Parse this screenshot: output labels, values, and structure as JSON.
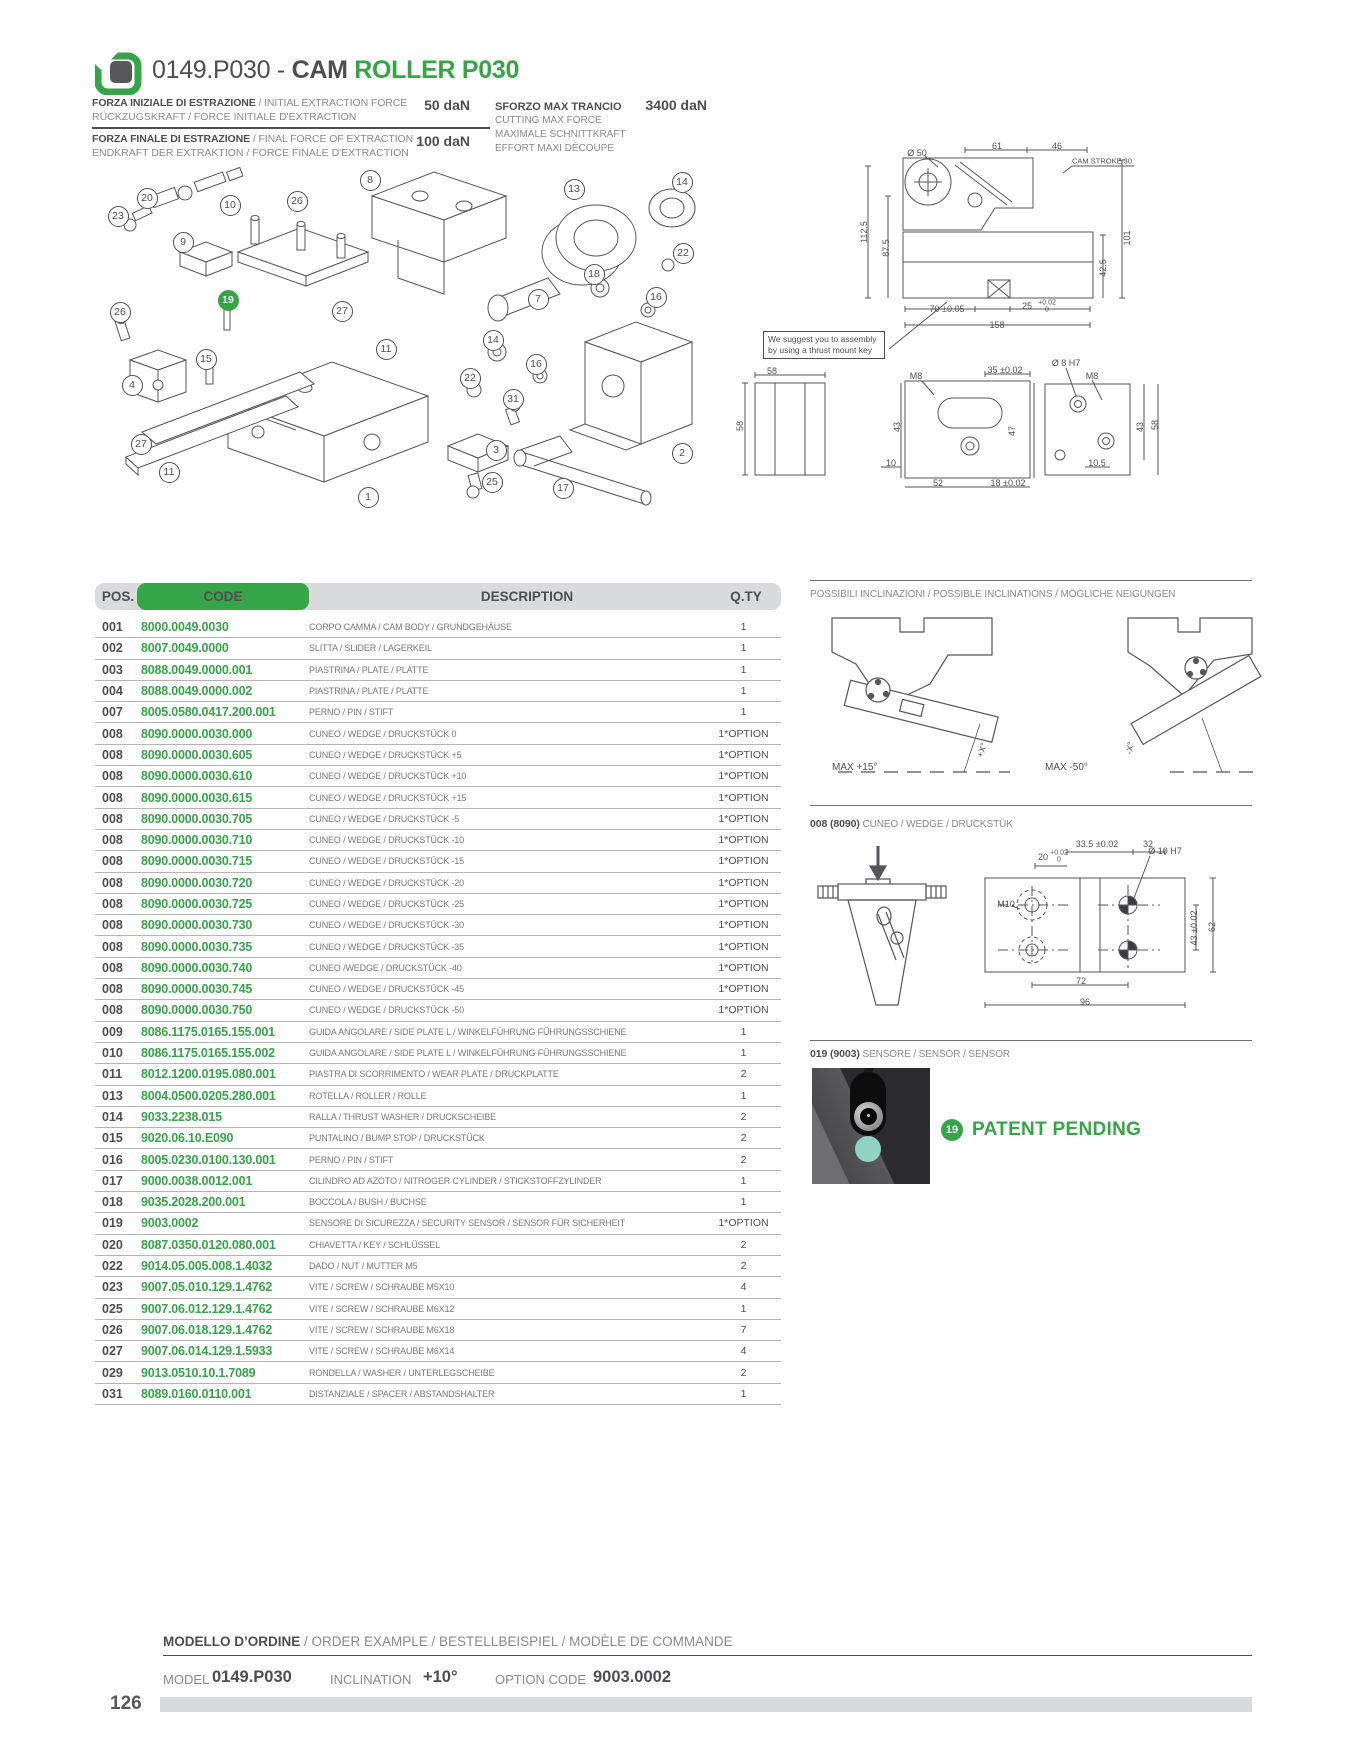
{
  "colors": {
    "accent_green": "#36a548",
    "dark_text": "#4e4e50",
    "muted_text": "#8a8a8c",
    "table_header_bg": "#d9dadb",
    "row_line": "#b4b4b6",
    "sensor_led_teal": "#8fd4c2"
  },
  "header": {
    "title_prefix": "0149.P030 - ",
    "title_cam": "CAM",
    "title_green": " ROLLER P030",
    "specs": [
      {
        "line1_bold": "FORZA INIZIALE DI ESTRAZIONE",
        "line1_rest": " / INITIAL EXTRACTION FORCE",
        "line2": "RÜCKZUGSKRAFT / FORCE INITIALE D'EXTRACTION",
        "value": "50 daN"
      },
      {
        "line1_bold": "FORZA FINALE DI ESTRAZIONE",
        "line1_rest": " / FINAL FORCE OF EXTRACTION",
        "line2": "ENDKRAFT DER EXTRAKTION / FORCE FINALE D'EXTRACTION",
        "value": "100 daN"
      }
    ],
    "max_shear": {
      "label": "SFORZO MAX TRANCIO",
      "value": "3400 daN",
      "sub1": "CUTTING MAX FORCE",
      "sub2": "MAXIMALE SCHNITTKRAFT",
      "sub3": "EFFORT MAXI DÉCOUPE"
    }
  },
  "drawings": {
    "note": "We suggest you to assembly by using a thrust mount key",
    "cam_stroke_label": "CAM STROKE 30"
  },
  "table": {
    "headers": {
      "pos": "POS.",
      "code": "CODE",
      "description": "DESCRIPTION",
      "qty": "Q.TY"
    },
    "rows": [
      {
        "pos": "001",
        "code": "8000.0049.0030",
        "desc": "CORPO CAMMA / CAM BODY / GRUNDGEHÄUSE",
        "qty": "1"
      },
      {
        "pos": "002",
        "code": "8007.0049.0000",
        "desc": "SLITTA / SLIDER / LAGERKEIL",
        "qty": "1"
      },
      {
        "pos": "003",
        "code": "8088.0049.0000.001",
        "desc": "PIASTRINA / PLATE / PLATTE",
        "qty": "1"
      },
      {
        "pos": "004",
        "code": "8088.0049.0000.002",
        "desc": "PIASTRINA / PLATE / PLATTE",
        "qty": "1"
      },
      {
        "pos": "007",
        "code": "8005.0580.0417.200.001",
        "desc": "PERNO / PIN / STIFT",
        "qty": "1"
      },
      {
        "pos": "008",
        "code": "8090.0000.0030.000",
        "desc": "CUNEO / WEDGE / DRUCKSTÜCK 0",
        "qty": "1*OPTION"
      },
      {
        "pos": "008",
        "code": "8090.0000.0030.605",
        "desc": "CUNEO / WEDGE / DRUCKSTÜCK +5",
        "qty": "1*OPTION"
      },
      {
        "pos": "008",
        "code": "8090.0000.0030.610",
        "desc": "CUNEO / WEDGE / DRUCKSTÜCK +10",
        "qty": "1*OPTION"
      },
      {
        "pos": "008",
        "code": "8090.0000.0030.615",
        "desc": "CUNEO / WEDGE / DRUCKSTÜCK +15",
        "qty": "1*OPTION"
      },
      {
        "pos": "008",
        "code": "8090.0000.0030.705",
        "desc": "CUNEO / WEDGE / DRUCKSTÜCK -5",
        "qty": "1*OPTION"
      },
      {
        "pos": "008",
        "code": "8090.0000.0030.710",
        "desc": "CUNEO / WEDGE / DRUCKSTÜCK -10",
        "qty": "1*OPTION"
      },
      {
        "pos": "008",
        "code": "8090.0000.0030.715",
        "desc": "CUNEO / WEDGE / DRUCKSTÜCK -15",
        "qty": "1*OPTION"
      },
      {
        "pos": "008",
        "code": "8090.0000.0030.720",
        "desc": "CUNEO / WEDGE / DRUCKSTÜCK -20",
        "qty": "1*OPTION"
      },
      {
        "pos": "008",
        "code": "8090.0000.0030.725",
        "desc": "CUNEO / WEDGE / DRUCKSTÜCK -25",
        "qty": "1*OPTION"
      },
      {
        "pos": "008",
        "code": "8090.0000.0030.730",
        "desc": "CUNEO / WEDGE / DRUCKSTÜCK -30",
        "qty": "1*OPTION"
      },
      {
        "pos": "008",
        "code": "8090.0000.0030.735",
        "desc": "CUNEO / WEDGE / DRUCKSTÜCK -35",
        "qty": "1*OPTION"
      },
      {
        "pos": "008",
        "code": "8090.0000.0030.740",
        "desc": "CUNEO /WEDGE / DRUCKSTÜCK -40",
        "qty": "1*OPTION"
      },
      {
        "pos": "008",
        "code": "8090.0000.0030.745",
        "desc": "CUNEO / WEDGE / DRUCKSTÜCK -45",
        "qty": "1*OPTION"
      },
      {
        "pos": "008",
        "code": "8090.0000.0030.750",
        "desc": "CUNEO / WEDGE / DRUCKSTÜCK -50",
        "qty": "1*OPTION"
      },
      {
        "pos": "009",
        "code": "8086.1175.0165.155.001",
        "desc": "GUIDA ANGOLARE / SIDE PLATE L / WINKELFÜHRUNG FÜHRUNGSSCHIENE",
        "qty": "1"
      },
      {
        "pos": "010",
        "code": "8086.1175.0165.155.002",
        "desc": "GUIDA ANGOLARE / SIDE PLATE L / WINKELFÜHRUNG FÜHRUNGSSCHIENE",
        "qty": "1"
      },
      {
        "pos": "011",
        "code": "8012.1200.0195.080.001",
        "desc": "PIASTRA DI SCORRIMENTO / WEAR PLATE / DRUCKPLATTE",
        "qty": "2"
      },
      {
        "pos": "013",
        "code": "8004.0500.0205.280.001",
        "desc": "ROTELLA / ROLLER / ROLLE",
        "qty": "1"
      },
      {
        "pos": "014",
        "code": "9033.2238.015",
        "desc": "RALLA / THRUST WASHER / DRUCKSCHEIBE",
        "qty": "2"
      },
      {
        "pos": "015",
        "code": "9020.06.10.E090",
        "desc": "PUNTALINO / BUMP STOP / DRUCKSTÜCK",
        "qty": "2"
      },
      {
        "pos": "016",
        "code": "8005.0230.0100.130.001",
        "desc": "PERNO / PIN / STIFT",
        "qty": "2"
      },
      {
        "pos": "017",
        "code": "9000.0038.0012.001",
        "desc": "CILINDRO AD AZOTO / NITROGER CYLINDER / STICKSTOFFZYLINDER",
        "qty": "1"
      },
      {
        "pos": "018",
        "code": "9035.2028.200.001",
        "desc": "BOCCOLA / BUSH / BUCHSE",
        "qty": "1"
      },
      {
        "pos": "019",
        "code": "9003.0002",
        "desc": "SENSORE DI SICUREZZA / SECURITY SENSOR / SENSOR FÜR SICHERHEIT",
        "qty": "1*OPTION"
      },
      {
        "pos": "020",
        "code": "8087.0350.0120.080.001",
        "desc": "CHIAVETTA / KEY / SCHLÜSSEL",
        "qty": "2"
      },
      {
        "pos": "022",
        "code": "9014.05.005.008.1.4032",
        "desc": "DADO / NUT / MUTTER M5",
        "qty": "2"
      },
      {
        "pos": "023",
        "code": "9007.05.010.129.1.4762",
        "desc": "VITE / SCREW / SCHRAUBE M5X10",
        "qty": "4"
      },
      {
        "pos": "025",
        "code": "9007.06.012.129.1.4762",
        "desc": "VITE / SCREW / SCHRAUBE M6X12",
        "qty": "1"
      },
      {
        "pos": "026",
        "code": "9007.06.018.129.1.4762",
        "desc": "VITE / SCREW / SCHRAUBE M6X18",
        "qty": "7"
      },
      {
        "pos": "027",
        "code": "9007.06.014.129.1.5933",
        "desc": "VITE / SCREW / SCHRAUBE M6X14",
        "qty": "4"
      },
      {
        "pos": "029",
        "code": "9013.0510.10.1.7089",
        "desc": "RONDELLA / WASHER / UNTERLEGSCHEIBE",
        "qty": "2"
      },
      {
        "pos": "031",
        "code": "8089.0160.0110.001",
        "desc": "DISTANZIALE / SPACER / ABSTANDSHALTER",
        "qty": "1"
      }
    ]
  },
  "exploded": {
    "callouts": [
      {
        "n": "23",
        "x": 117,
        "y": 215
      },
      {
        "n": "20",
        "x": 146,
        "y": 197
      },
      {
        "n": "10",
        "x": 229,
        "y": 204
      },
      {
        "n": "26",
        "x": 296,
        "y": 200
      },
      {
        "n": "8",
        "x": 369,
        "y": 179
      },
      {
        "n": "13",
        "x": 573,
        "y": 188
      },
      {
        "n": "14",
        "x": 681,
        "y": 181
      },
      {
        "n": "9",
        "x": 182,
        "y": 241
      },
      {
        "n": "22",
        "x": 682,
        "y": 252
      },
      {
        "n": "18",
        "x": 593,
        "y": 273
      },
      {
        "n": "16",
        "x": 655,
        "y": 296
      },
      {
        "n": "7",
        "x": 537,
        "y": 298
      },
      {
        "n": "19",
        "x": 227,
        "y": 299,
        "g": true
      },
      {
        "n": "27",
        "x": 341,
        "y": 310
      },
      {
        "n": "26",
        "x": 119,
        "y": 311
      },
      {
        "n": "11",
        "x": 385,
        "y": 348
      },
      {
        "n": "14",
        "x": 492,
        "y": 339
      },
      {
        "n": "22",
        "x": 469,
        "y": 377
      },
      {
        "n": "16",
        "x": 535,
        "y": 363
      },
      {
        "n": "31",
        "x": 512,
        "y": 398
      },
      {
        "n": "4",
        "x": 131,
        "y": 384
      },
      {
        "n": "15",
        "x": 205,
        "y": 358
      },
      {
        "n": "3",
        "x": 495,
        "y": 449
      },
      {
        "n": "2",
        "x": 681,
        "y": 452
      },
      {
        "n": "27",
        "x": 140,
        "y": 443
      },
      {
        "n": "11",
        "x": 168,
        "y": 471
      },
      {
        "n": "25",
        "x": 491,
        "y": 481
      },
      {
        "n": "1",
        "x": 367,
        "y": 496
      },
      {
        "n": "17",
        "x": 562,
        "y": 487
      }
    ]
  },
  "annotations": [
    {
      "t": "Ø 50",
      "x": 917,
      "y": 153
    },
    {
      "t": "61",
      "x": 997,
      "y": 146
    },
    {
      "t": "46",
      "x": 1057,
      "y": 146
    },
    {
      "t": "CAM STROKE 30",
      "x": 1102,
      "y": 161,
      "s": 7.5
    },
    {
      "t": "112.5",
      "x": 864,
      "y": 232,
      "r": -90
    },
    {
      "t": "87.5",
      "x": 886,
      "y": 248,
      "r": -90
    },
    {
      "t": "101",
      "x": 1127,
      "y": 238,
      "r": -90
    },
    {
      "t": "42.5",
      "x": 1103,
      "y": 268,
      "r": -90
    },
    {
      "t": "70 ±0.05",
      "x": 947,
      "y": 309
    },
    {
      "t": "25",
      "x": 1027,
      "y": 306
    },
    {
      "t": "+0.02",
      "x": 1047,
      "y": 303,
      "s": 7
    },
    {
      "t": "0",
      "x": 1047,
      "y": 310,
      "s": 7
    },
    {
      "t": "158",
      "x": 997,
      "y": 325
    },
    {
      "t": "58",
      "x": 772,
      "y": 371
    },
    {
      "t": "M8",
      "x": 916,
      "y": 376
    },
    {
      "t": "35 ±0.02",
      "x": 1005,
      "y": 370
    },
    {
      "t": "Ø 8 H7",
      "x": 1066,
      "y": 363
    },
    {
      "t": "M8",
      "x": 1092,
      "y": 376
    },
    {
      "t": "58",
      "x": 740,
      "y": 426,
      "r": -90
    },
    {
      "t": "43",
      "x": 897,
      "y": 427,
      "r": -90
    },
    {
      "t": "47",
      "x": 1012,
      "y": 431,
      "r": -90
    },
    {
      "t": "43",
      "x": 1140,
      "y": 427,
      "r": -90
    },
    {
      "t": "58",
      "x": 1155,
      "y": 425,
      "r": -90
    },
    {
      "t": "10",
      "x": 891,
      "y": 463
    },
    {
      "t": "52",
      "x": 938,
      "y": 483
    },
    {
      "t": "18 ±0.02",
      "x": 1008,
      "y": 483
    },
    {
      "t": "10.5",
      "x": 1097,
      "y": 463
    },
    {
      "t": "+X°",
      "x": 982,
      "y": 750,
      "r": -72
    },
    {
      "t": "-X°",
      "x": 1130,
      "y": 748,
      "r": -80
    },
    {
      "t": "33.5 ±0.02",
      "x": 1097,
      "y": 844
    },
    {
      "t": "32",
      "x": 1148,
      "y": 844
    },
    {
      "t": "20",
      "x": 1043,
      "y": 857
    },
    {
      "t": "+0.02",
      "x": 1059,
      "y": 853,
      "s": 7
    },
    {
      "t": "0",
      "x": 1059,
      "y": 860,
      "s": 7
    },
    {
      "t": "Ø 10 H7",
      "x": 1165,
      "y": 851
    },
    {
      "t": "M10",
      "x": 1006,
      "y": 904
    },
    {
      "t": "43 ±0.02",
      "x": 1194,
      "y": 928,
      "r": -90
    },
    {
      "t": "62",
      "x": 1212,
      "y": 927,
      "r": -90
    },
    {
      "t": "72",
      "x": 1081,
      "y": 981
    },
    {
      "t": "96",
      "x": 1085,
      "y": 1002
    }
  ],
  "sections": {
    "inclinations_title": "POSSIBILI INCLINAZIONI / POSSIBLE INCLINATIONS / MÖGLICHE NEIGUNGEN",
    "max_left": "MAX +15°",
    "max_right": "MAX -50°",
    "wedge_prefix": "008 (8090)",
    "wedge_title": " CUNEO / WEDGE / DRUCKSTÜK",
    "sensor_prefix": "019 (9003)",
    "sensor_title": " SENSORE / SENSOR / SENSOR",
    "patent_badge": "19",
    "patent_text": "PATENT PENDING"
  },
  "footer": {
    "order_title_bold": "MODELLO D’ORDINE",
    "order_title_rest": " / ORDER EXAMPLE / BESTELLBEISPIEL / MODÈLE DE COMMANDE",
    "model_label": "MODEL",
    "model_value": "0149.P030",
    "inclination_label": "INCLINATION",
    "inclination_value": "+10°",
    "option_label": "OPTION CODE",
    "option_value": "9003.0002",
    "page_number": "126"
  }
}
